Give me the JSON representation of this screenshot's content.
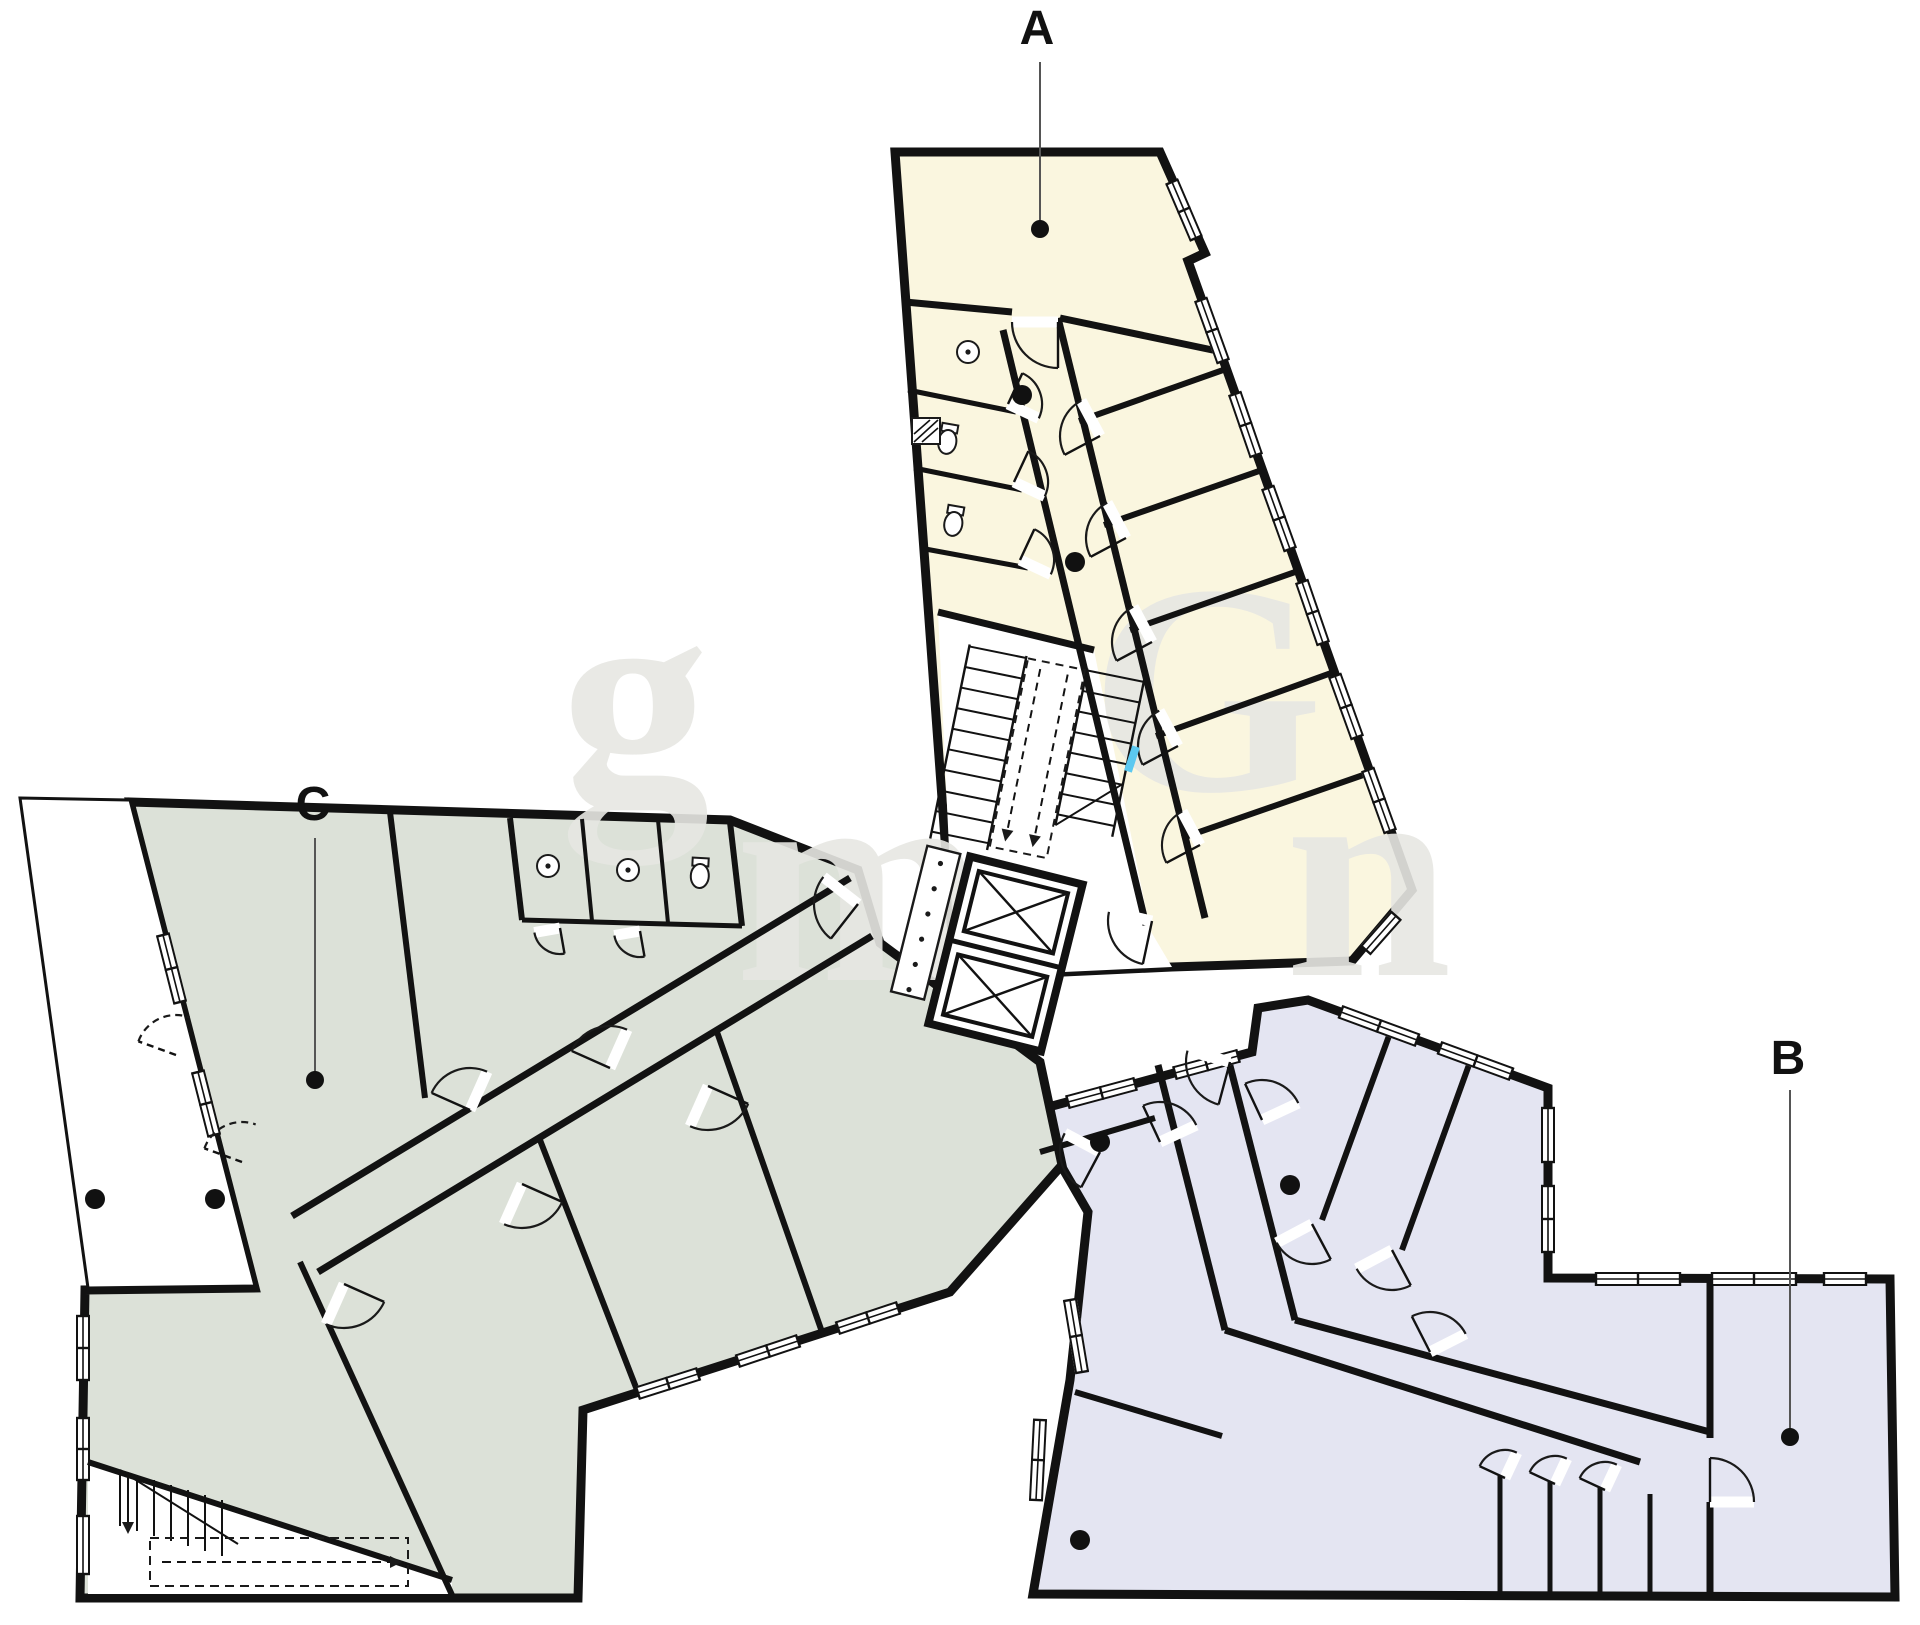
{
  "plan": {
    "type": "architectural-floor-plan",
    "floors_shown": 1,
    "wings": [
      {
        "id": "A",
        "label": "A",
        "fill_key": "wing_a_fill"
      },
      {
        "id": "B",
        "label": "B",
        "fill_key": "wing_b_fill"
      },
      {
        "id": "C",
        "label": "C",
        "fill_key": "wing_c_fill"
      }
    ],
    "floor_labels": {
      "a": {
        "text": "A",
        "x": 1037,
        "y": 44,
        "line": {
          "x1": 1040,
          "y1": 62,
          "x2": 1040,
          "y2": 221
        },
        "dot": {
          "cx": 1040,
          "cy": 229
        }
      },
      "b": {
        "text": "B",
        "x": 1788,
        "y": 1074,
        "line": {
          "x1": 1790,
          "y1": 1090,
          "x2": 1790,
          "y2": 1429
        },
        "dot": {
          "cx": 1790,
          "cy": 1437
        }
      },
      "c": {
        "text": "C",
        "x": 313,
        "y": 820,
        "line": {
          "x1": 315,
          "y1": 838,
          "x2": 315,
          "y2": 1072
        },
        "dot": {
          "cx": 315,
          "cy": 1080
        }
      }
    },
    "colors": {
      "wing_a_fill": "#FAF6DF",
      "wing_b_fill": "#E4E5F2",
      "wing_c_fill": "#DCE1D8",
      "wall": "#121212",
      "thin_line": "#1a1a1a",
      "leader_line": "#555555",
      "dot": "#111111",
      "floor_white": "#FFFFFF",
      "watermark": "#E7E7E3",
      "accent_window": "#5BC8F0"
    },
    "watermark": {
      "letters": [
        {
          "ch": "g",
          "x": 560,
          "y": 800
        },
        {
          "ch": "m",
          "x": 735,
          "y": 980
        },
        {
          "ch": "G",
          "x": 1090,
          "y": 790
        },
        {
          "ch": "n",
          "x": 1285,
          "y": 975
        }
      ]
    }
  }
}
